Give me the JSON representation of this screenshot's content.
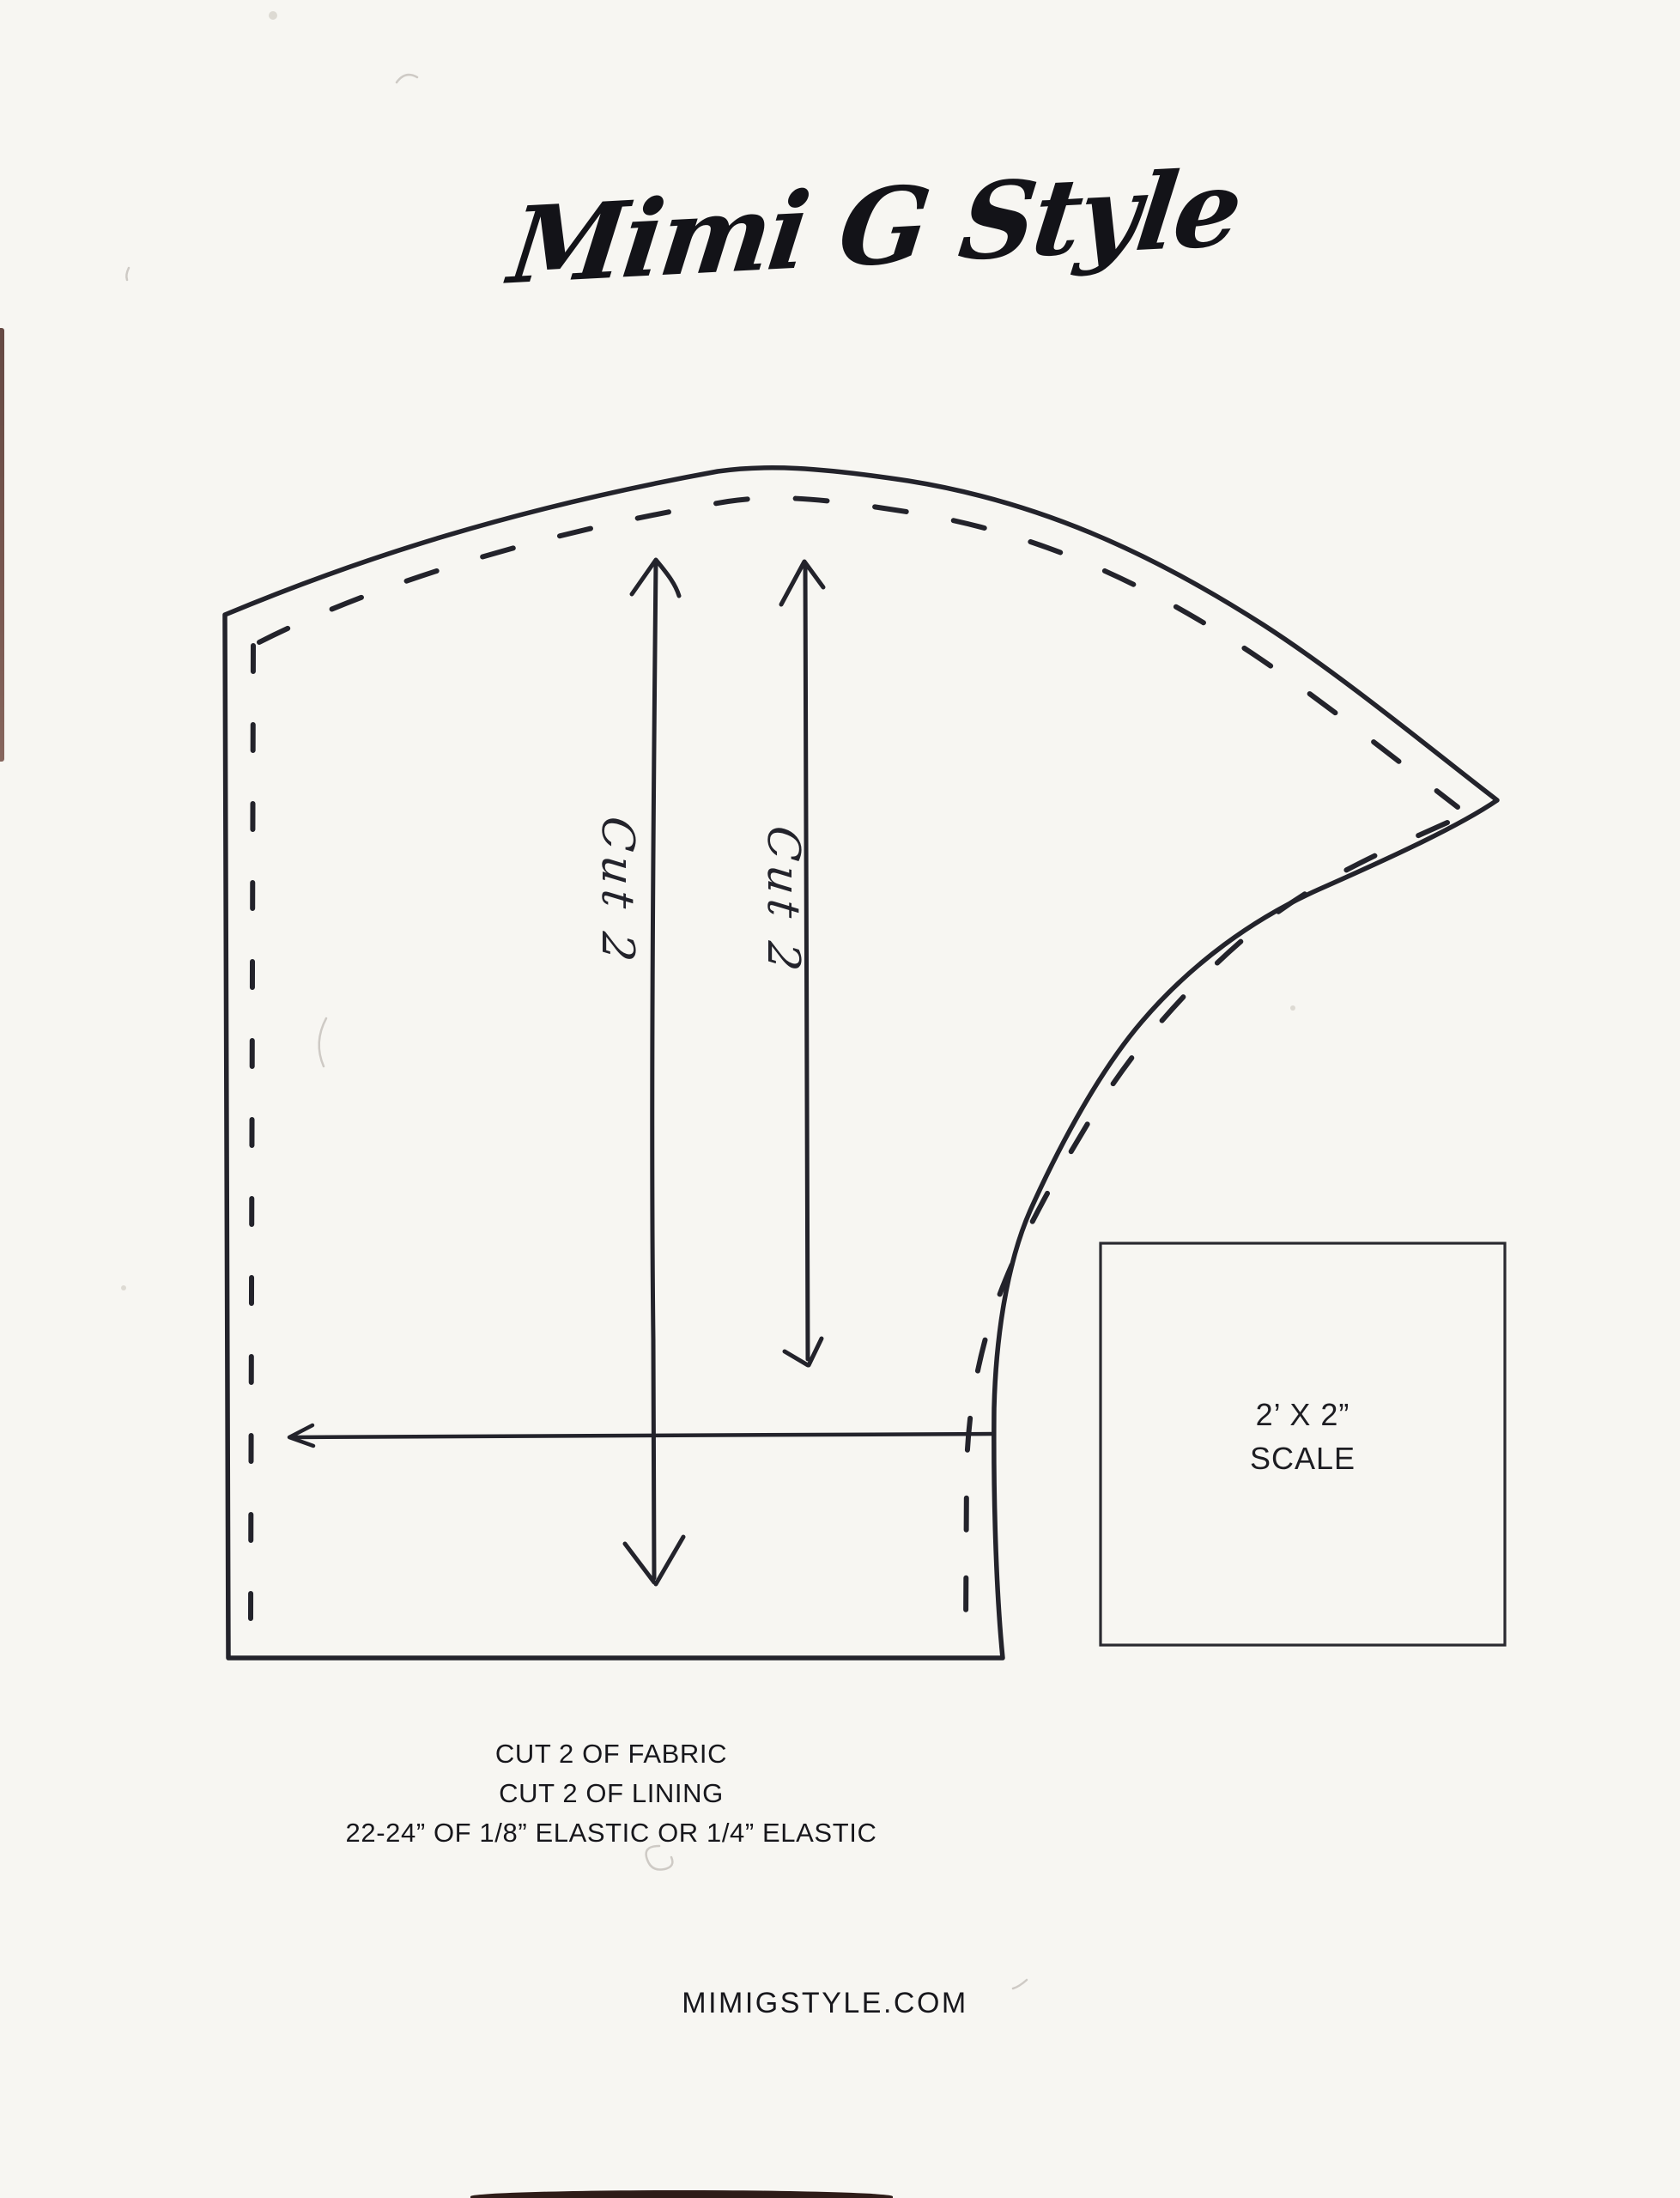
{
  "document": {
    "brand": "Mimi G Style",
    "website": "MIMIGSTYLE.COM"
  },
  "pattern_piece": {
    "grainline_left_label": "Cut 2",
    "grainline_right_label": "Cut 2"
  },
  "scale_box": {
    "dimensions": "2’ X 2”",
    "label": "SCALE"
  },
  "instructions": {
    "lines": [
      "CUT 2 OF FABRIC",
      "CUT 2 OF LINING",
      "22-24” OF 1/8” ELASTIC OR 1/4” ELASTIC"
    ]
  },
  "colors": {
    "ink": "#23232b",
    "paper": "#f7f6f2"
  }
}
